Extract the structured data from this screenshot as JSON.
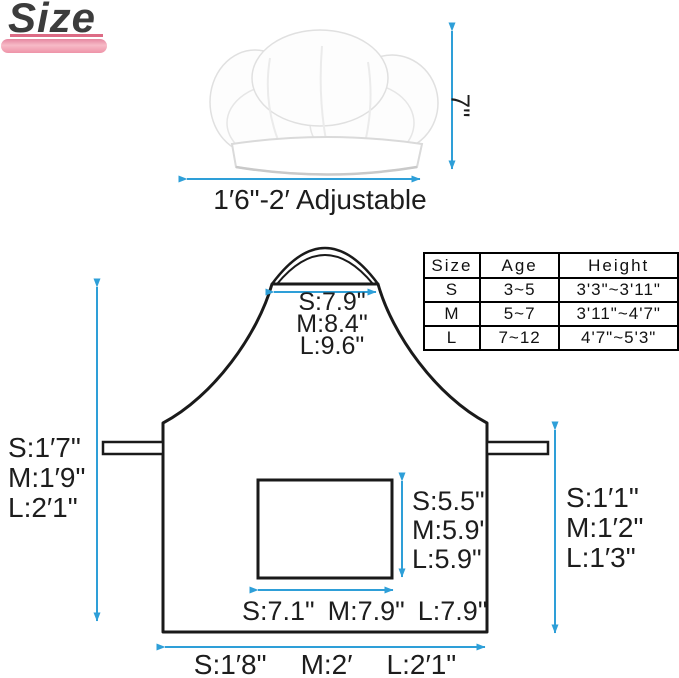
{
  "colors": {
    "arrow_blue": "#2e9fd8",
    "outline_black": "#1a1a1a",
    "pink_bar": "#ef94a8",
    "pink_line": "#dd6b85"
  },
  "title": "Size",
  "hat": {
    "height_label": "7\"",
    "width_label": "1′6\"-2′ Adjustable"
  },
  "size_table": {
    "headers": [
      "Size",
      "Age",
      "Height"
    ],
    "rows": [
      [
        "S",
        "3~5",
        "3'3\"~3'11\""
      ],
      [
        "M",
        "5~7",
        "3'11\"~4'7\""
      ],
      [
        "L",
        "7~12",
        "4'7\"~5'3\""
      ]
    ]
  },
  "apron": {
    "neck_width": {
      "s": "S:7.9\"",
      "m": "M:8.4\"",
      "l": "L:9.6\""
    },
    "length": {
      "s": "S:1′7\"",
      "m": "M:1′9\"",
      "l": "L:2′1\""
    },
    "side_height": {
      "s": "S:1′1\"",
      "m": "M:1′2\"",
      "l": "L:1′3\""
    },
    "pocket_height": {
      "s": "S:5.5\"",
      "m": "M:5.9\"",
      "l": "L:5.9\""
    },
    "pocket_width": {
      "s": "S:7.1\"",
      "m": "M:7.9\"",
      "l": "L:7.9\""
    },
    "bottom_width": {
      "s": "S:1′8\"",
      "m": "M:2′",
      "l": "L:2′1\""
    }
  }
}
